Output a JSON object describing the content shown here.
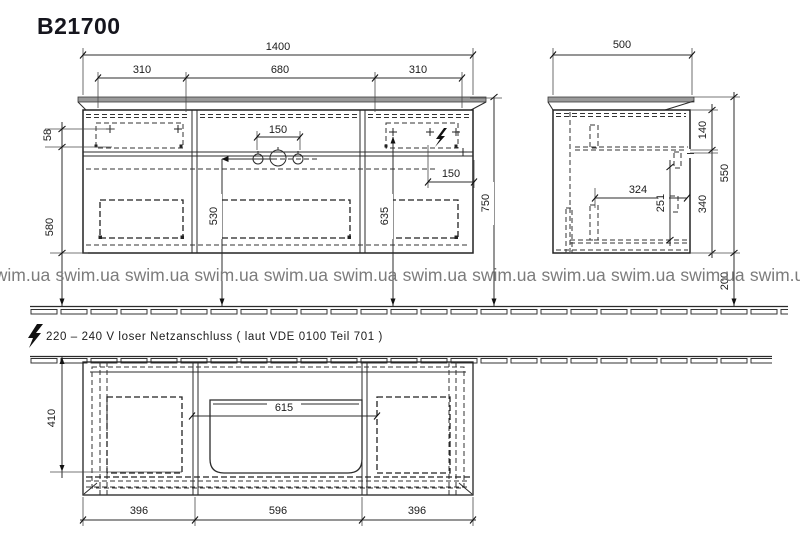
{
  "title": "B21700",
  "watermark": {
    "text": "swim.ua"
  },
  "electrical_note": {
    "text": "220 – 240 V loser Netzanschluss ( laut VDE 0100 Teil 701 )"
  },
  "front_view": {
    "dims": {
      "total_width": "1400",
      "left_drawer_width": "310",
      "center_width": "680",
      "right_drawer_width": "310",
      "tap_hole_spacing": "150",
      "socket_to_edge": "150",
      "top_offset": "58",
      "lower_height": "580",
      "drain_center_height": "530",
      "socket_height": "635",
      "worktop_height": "750"
    }
  },
  "side_view": {
    "dims": {
      "depth": "500",
      "top_drawer_height": "140",
      "cabinet_height": "550",
      "lower_zone_height": "340",
      "inner_depth": "324",
      "inner_clearance": "251",
      "floor_clearance": "200"
    }
  },
  "plan_view": {
    "dims": {
      "inner_depth": "410",
      "basin_cutout_width": "615",
      "left_section_width": "396",
      "center_section_width": "596",
      "right_section_width": "396"
    }
  },
  "colors": {
    "worktop": "#9a9a9a",
    "line": "#2b2b2b",
    "watermark": "#7c7c7c"
  }
}
